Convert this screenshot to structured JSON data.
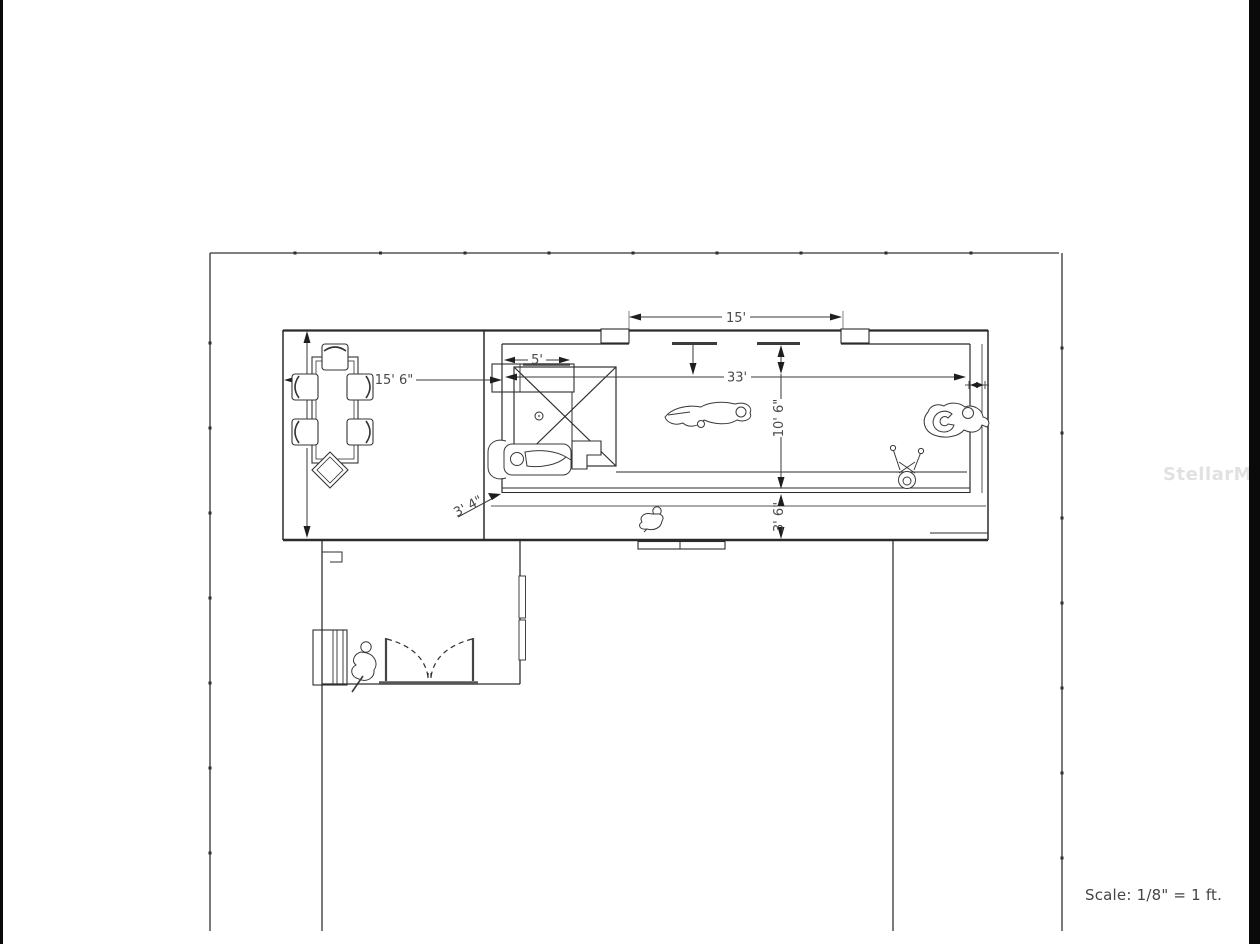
{
  "plan": {
    "watermark": "StellarMLS",
    "scale_note": "Scale: 1/8\" = 1 ft.",
    "dimensions": {
      "screen_opening": "15'",
      "lanai_length": "33'",
      "pool_width": "10' 6\"",
      "rear_walkway": "3' 6\"",
      "patio_width": "15' 6\"",
      "patio_depth": "15'",
      "spa_width": "5'",
      "corner_offset": "3' 4\""
    }
  }
}
